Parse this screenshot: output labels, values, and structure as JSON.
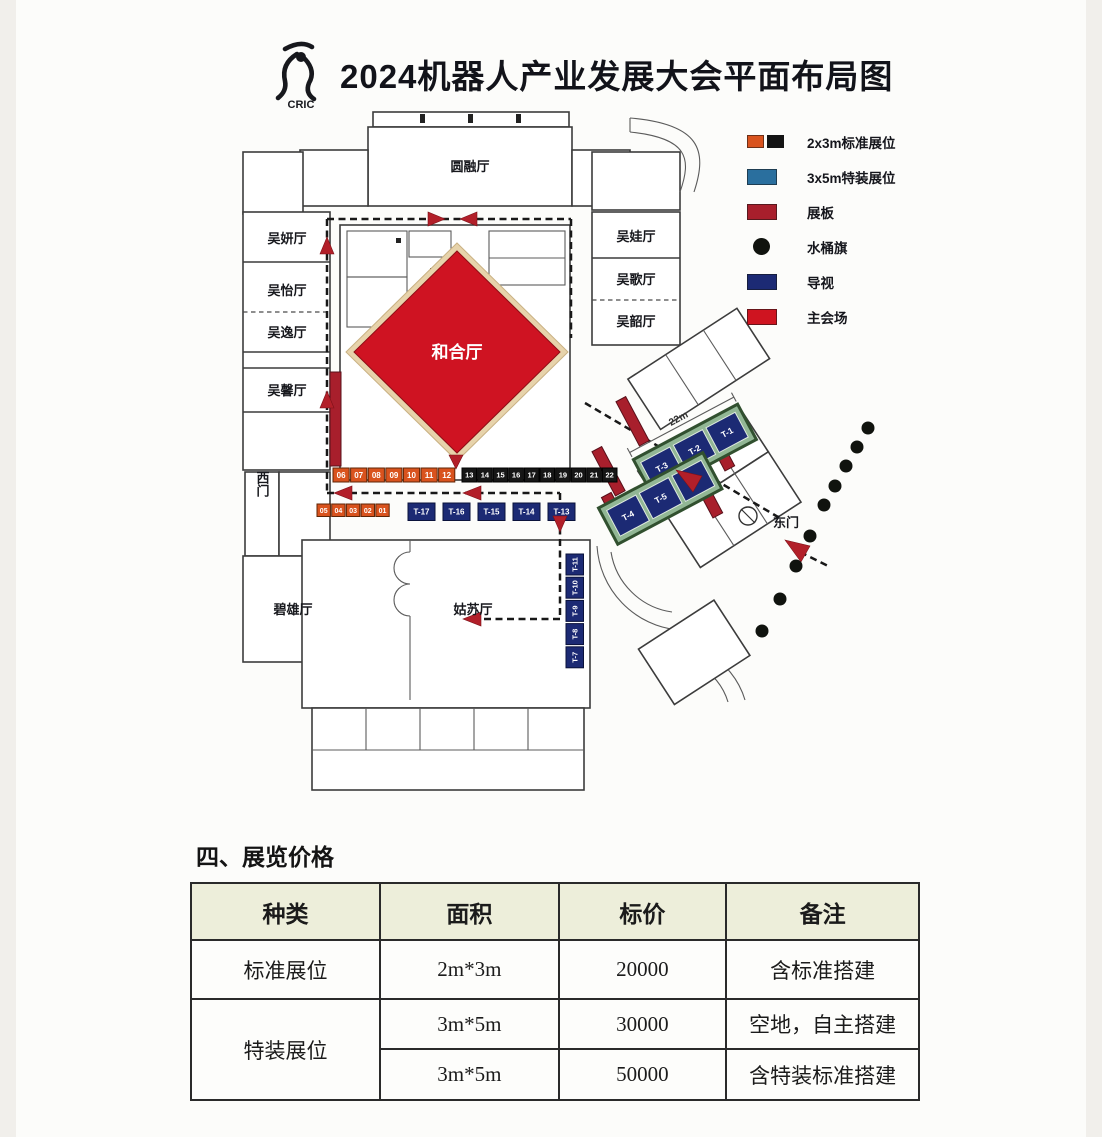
{
  "header": {
    "logo_text": "CRIC",
    "title": "2024机器人产业发展大会平面布局图"
  },
  "legend": {
    "items": [
      {
        "type": "standard-booth",
        "label": "2x3m标准展位",
        "colors": [
          "#d9531e",
          "#141414"
        ]
      },
      {
        "type": "special-booth",
        "label": "3x5m特装展位",
        "colors": [
          "#2a6f9e"
        ]
      },
      {
        "type": "display-board",
        "label": "展板",
        "colors": [
          "#a81f2c"
        ]
      },
      {
        "type": "bucket-flag",
        "label": "水桶旗",
        "colors": [
          "#10130e"
        ]
      },
      {
        "type": "signage",
        "label": "导视",
        "colors": [
          "#1c2a74"
        ]
      },
      {
        "type": "main-venue",
        "label": "主会场",
        "colors": [
          "#cf1420"
        ]
      }
    ]
  },
  "map": {
    "halls": {
      "yuanrong": "圆融厅",
      "wuyan": "吴妍厅",
      "wuyi": "吴怡厅",
      "wuyi2": "吴逸厅",
      "wuxin": "吴馨厅",
      "wuwa": "吴娃厅",
      "wuge": "吴歌厅",
      "wushao": "吴韶厅",
      "hehe": "和合厅",
      "gusu": "姑苏厅",
      "bixiong": "碧雄厅",
      "west_gate": "西门",
      "east_gate": "东门"
    },
    "dimension_label": "22m",
    "booths": {
      "orange_row": [
        "06",
        "07",
        "08",
        "09",
        "10",
        "11",
        "12"
      ],
      "black_row": [
        "13",
        "14",
        "15",
        "16",
        "17",
        "18",
        "19",
        "20",
        "21",
        "22"
      ],
      "orange_small_row": [
        "05",
        "04",
        "03",
        "02",
        "01"
      ],
      "t_row_horizontal": [
        "T-17",
        "T-16",
        "T-15",
        "T-14",
        "T-13"
      ],
      "t_col_vertical": [
        "T-11",
        "T-10",
        "T-9",
        "T-8",
        "T-7"
      ],
      "t_block_upper": [
        "T-3",
        "T-2",
        "T-1"
      ],
      "t_block_lower": [
        "T-4",
        "T-5",
        "T-6"
      ]
    }
  },
  "pricing": {
    "section_title": "四、展览价格",
    "headers": [
      "种类",
      "面积",
      "标价",
      "备注"
    ],
    "rows": [
      {
        "type": "标准展位",
        "area": "2m*3m",
        "price": "20000",
        "note": "含标准搭建"
      },
      {
        "type": "特装展位",
        "area": "3m*5m",
        "price": "30000",
        "note": "空地，自主搭建"
      },
      {
        "type": "",
        "area": "3m*5m",
        "price": "50000",
        "note": "含特装标准搭建"
      }
    ]
  }
}
